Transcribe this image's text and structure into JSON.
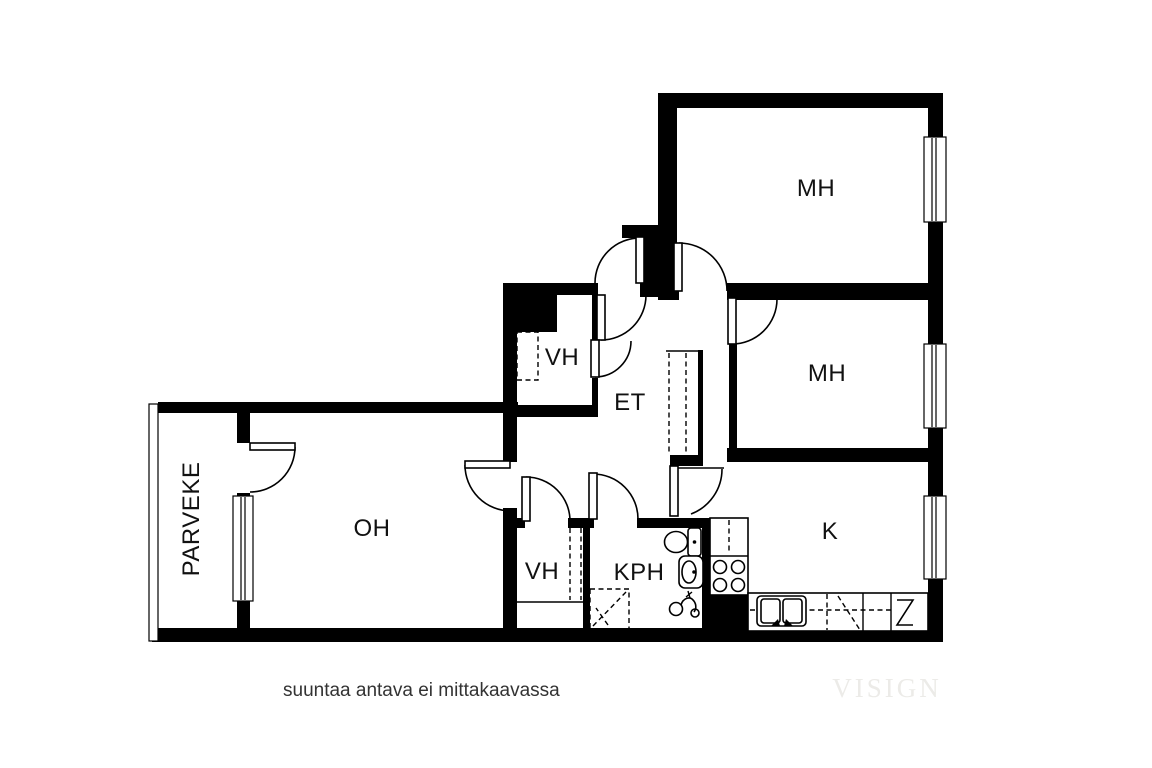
{
  "plan": {
    "title": "apartment-floor-plan",
    "rooms": [
      {
        "id": "mh1",
        "label": "MH"
      },
      {
        "id": "mh2",
        "label": "MH"
      },
      {
        "id": "k",
        "label": "K"
      },
      {
        "id": "oh",
        "label": "OH"
      },
      {
        "id": "et",
        "label": "ET"
      },
      {
        "id": "kph",
        "label": "KPH"
      },
      {
        "id": "vh_top",
        "label": "VH"
      },
      {
        "id": "vh_bottom",
        "label": "VH"
      },
      {
        "id": "parveke",
        "label": "PARVEKE"
      }
    ],
    "footer_note": "suuntaa antava ei mittakaavassa",
    "watermark": "VISIGN",
    "colors": {
      "wall": "#000000",
      "background": "#ffffff",
      "note_text": "#333333",
      "watermark": "#ecebe8"
    }
  }
}
